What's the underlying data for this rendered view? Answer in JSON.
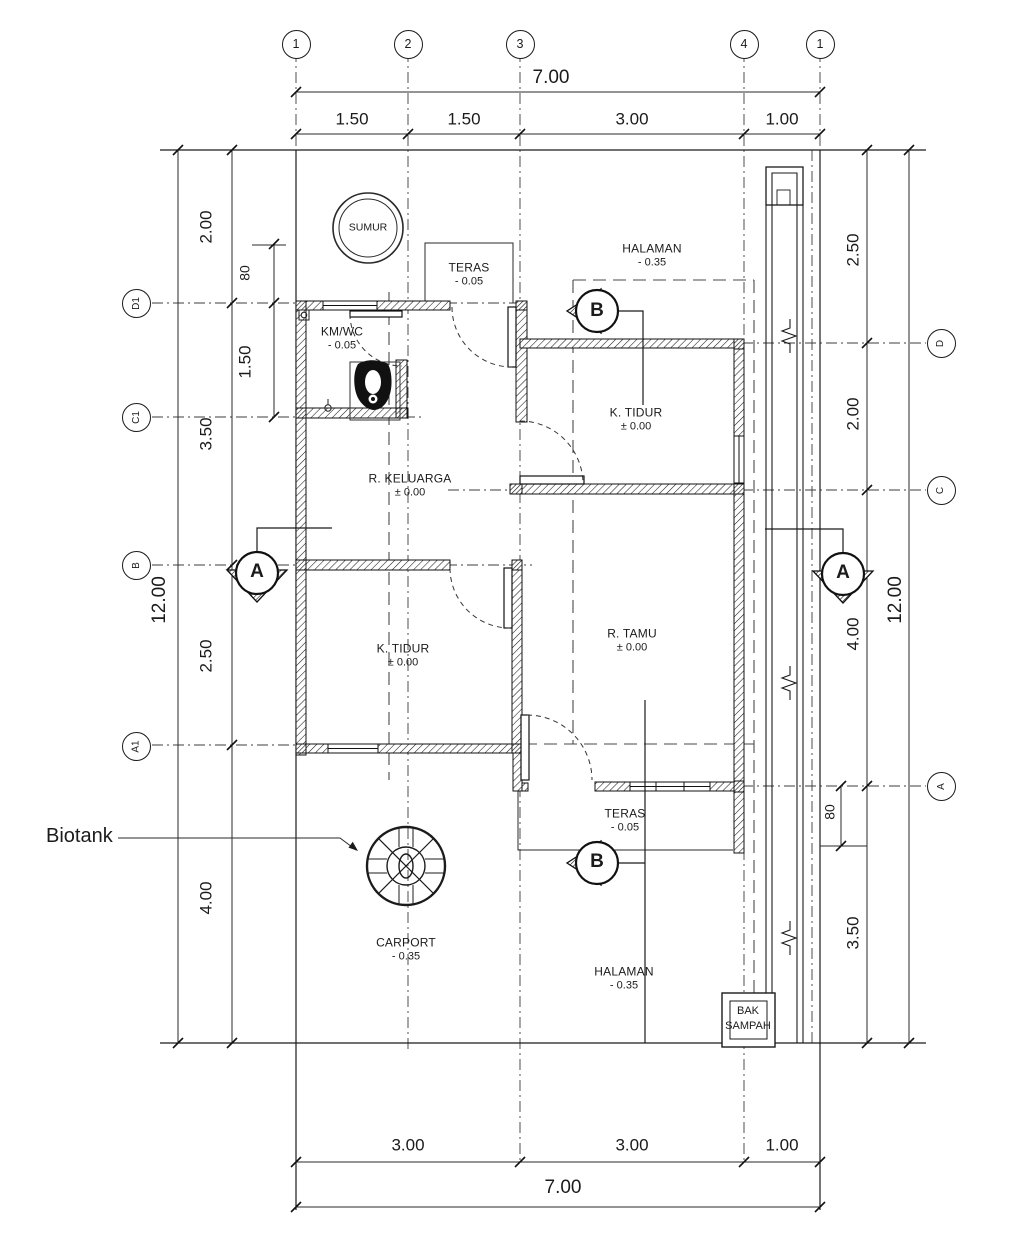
{
  "meta": {
    "drawing_type": "house floor plan",
    "ink_color": "#1b1b1b",
    "paper_color": "#ffffff"
  },
  "grid": {
    "top": [
      "1",
      "2",
      "3",
      "4",
      "1"
    ],
    "left": [
      "D1",
      "C1",
      "B",
      "A1"
    ],
    "right": [
      "D",
      "C",
      "A"
    ]
  },
  "dimensions": {
    "top": {
      "overall": "7.00",
      "segments": [
        "1.50",
        "1.50",
        "3.00",
        "1.00"
      ]
    },
    "bottom": {
      "overall": "7.00",
      "segments": [
        "3.00",
        "3.00",
        "1.00"
      ]
    },
    "left": {
      "overall": "12.00",
      "segments": [
        "2.00",
        "3.50",
        "2.50",
        "4.00"
      ],
      "sub_segments": [
        "80",
        "1.50"
      ]
    },
    "right": {
      "overall": "12.00",
      "segments": [
        "2.50",
        "2.00",
        "4.00",
        "3.50"
      ],
      "sub_segments": [
        "80"
      ]
    }
  },
  "rooms": [
    {
      "name": "TERAS",
      "level": "- 0.05"
    },
    {
      "name": "HALAMAN",
      "level": "- 0.35"
    },
    {
      "name": "KM/WC",
      "level": "- 0.05"
    },
    {
      "name": "K. TIDUR",
      "level": "± 0.00"
    },
    {
      "name": "R. KELUARGA",
      "level": "± 0.00"
    },
    {
      "name": "R. TAMU",
      "level": "± 0.00"
    },
    {
      "name": "K. TIDUR",
      "level": "± 0.00"
    },
    {
      "name": "TERAS",
      "level": "- 0.05"
    },
    {
      "name": "HALAMAN",
      "level": "- 0.35"
    },
    {
      "name": "CARPORT",
      "level": "- 0.35"
    }
  ],
  "annotations": {
    "sumur": "SUMUR",
    "bi": "Biotank",
    "bak_sampah": [
      "BAK",
      "SAMPAH"
    ]
  },
  "sections": {
    "a": "A",
    "b": "B"
  }
}
